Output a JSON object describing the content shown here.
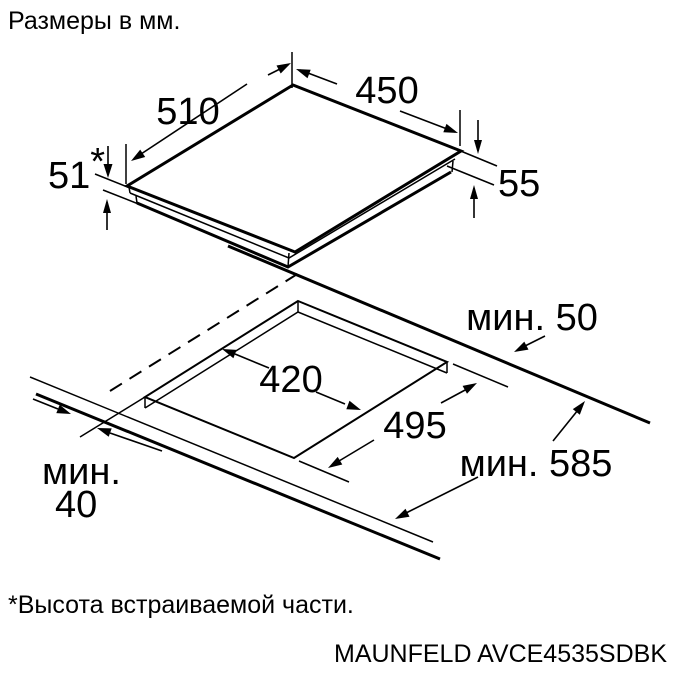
{
  "title": "Размеры в мм.",
  "footnote": "*Высота встраиваемой части.",
  "model": "MAUNFELD AVCE4535SDBK",
  "colors": {
    "line": "#000000",
    "background": "#ffffff"
  },
  "hob": {
    "width": "450",
    "depth": "510",
    "built_in_height": "51",
    "built_in_height_marker": "*",
    "edge_height": "55"
  },
  "cutout": {
    "width": "420",
    "depth": "495",
    "min_back_clearance": "мин. 50",
    "min_worktop_depth": "мин. 585",
    "min_front_clearance_word": "мин.",
    "min_front_clearance_value": "40"
  }
}
